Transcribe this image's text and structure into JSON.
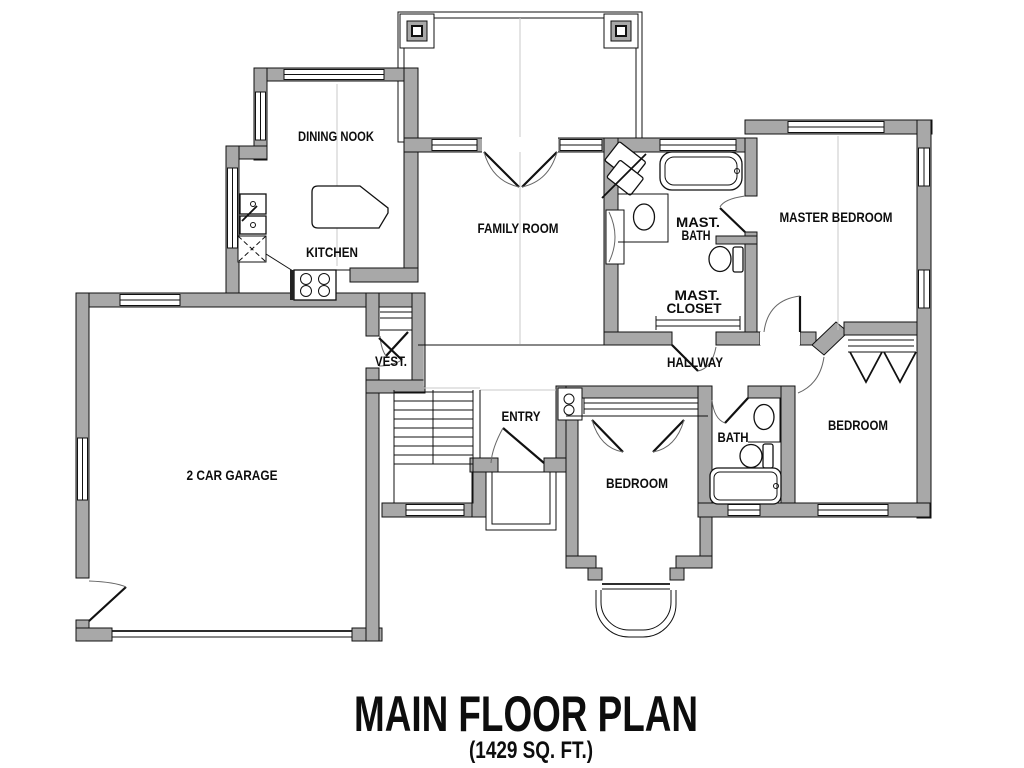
{
  "title": {
    "main": "MAIN FLOOR PLAN",
    "subtitle": "(1429 SQ. FT.)"
  },
  "rooms": {
    "dining_nook": "DINING NOOK",
    "kitchen": "KITCHEN",
    "family_room": "FAMILY ROOM",
    "master_bath": [
      "MAST.",
      "BATH"
    ],
    "master_closet": [
      "MAST.",
      "CLOSET"
    ],
    "master_bedroom": "MASTER BEDROOM",
    "hallway": "HALLWAY",
    "vestibule": "VEST.",
    "entry": "ENTRY",
    "garage": "2 CAR GARAGE",
    "bedroom_center": "BEDROOM",
    "bedroom_right": "BEDROOM",
    "bath": "BATH"
  },
  "colors": {
    "wall_fill": "#a8a8a8",
    "line": "#111111",
    "background": "#ffffff",
    "thin_line": "#c9c9c9"
  }
}
